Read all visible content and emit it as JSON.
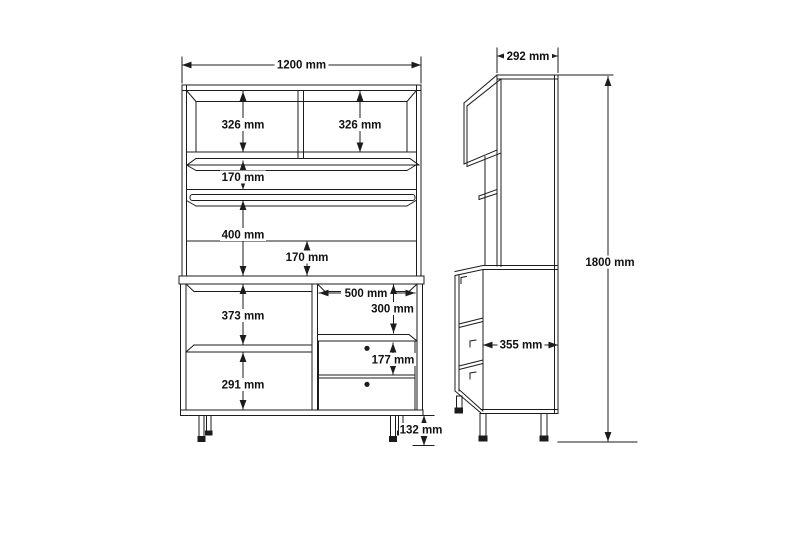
{
  "front_view": {
    "dims": {
      "overall_width": "1200 mm",
      "top_left_compartment_height": "326 mm",
      "top_right_compartment_height": "326 mm",
      "shelf_section_height": "170 mm",
      "open_section_height": "400 mm",
      "counter_gap_height": "170 mm",
      "base_upper_compartment_height": "373 mm",
      "niche_width": "500 mm",
      "niche_height": "300 mm",
      "base_lower_compartment_height": "291 mm",
      "drawer_height": "177 mm",
      "leg_height": "132 mm"
    }
  },
  "side_view": {
    "dims": {
      "upper_depth": "292 mm",
      "base_depth": "355 mm",
      "overall_height": "1800 mm"
    }
  },
  "style": {
    "background": "#ffffff",
    "line_color": "#1c1c1c",
    "label_color": "#111111",
    "knob_color": "#000000"
  }
}
